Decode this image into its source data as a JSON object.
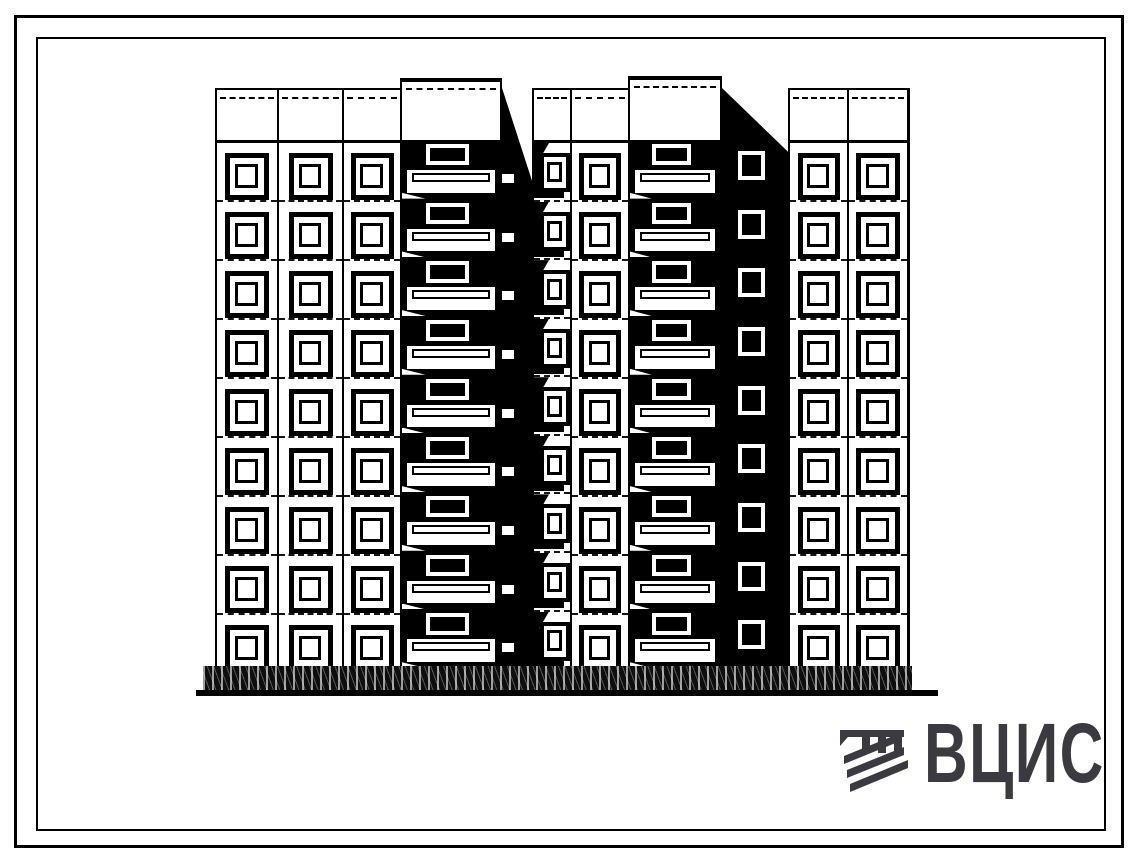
{
  "logo": {
    "text": "ВЦИС",
    "color": "#3a3a40",
    "icon": "vcis-stripes-icon"
  },
  "drawing": {
    "description": "front elevation of a 9-storey large-panel apartment block",
    "ink": "#000000",
    "paper": "#ffffff",
    "geometry": {
      "roof": 88,
      "parapet_bottom": 140,
      "base_top": 668,
      "floors": 9
    },
    "columns": [
      {
        "id": "col-a",
        "type": "windows",
        "x": 215,
        "w": 62,
        "win_w": 34,
        "win_h": 37
      },
      {
        "id": "col-b",
        "type": "windows",
        "x": 277,
        "w": 65,
        "win_w": 34,
        "win_h": 37
      },
      {
        "id": "col-c",
        "type": "windows",
        "x": 342,
        "w": 58,
        "win_w": 33,
        "win_h": 37
      },
      {
        "id": "shaft-1",
        "type": "shaft",
        "x": 400,
        "w": 102,
        "top": 78
      },
      {
        "id": "strip-1",
        "type": "strip",
        "x": 502,
        "w": 30,
        "diag": 0.16,
        "slabs": true
      },
      {
        "id": "col-d",
        "type": "windows",
        "x": 532,
        "w": 38,
        "win_w": 22,
        "win_h": 31,
        "narrow": true
      },
      {
        "id": "col-e",
        "type": "windows",
        "x": 570,
        "w": 58,
        "win_w": 32,
        "win_h": 37
      },
      {
        "id": "shaft-2",
        "type": "shaft",
        "x": 628,
        "w": 94,
        "top": 76
      },
      {
        "id": "strip-2",
        "type": "strip",
        "x": 722,
        "w": 66,
        "diag": 0.11,
        "windows": true,
        "strip_win": {
          "left": 16,
          "w": 27,
          "h": 29
        }
      },
      {
        "id": "col-f",
        "type": "windows",
        "x": 788,
        "w": 59,
        "win_w": 32,
        "win_h": 37
      },
      {
        "id": "col-g",
        "type": "windows",
        "x": 847,
        "w": 63,
        "win_w": 34,
        "win_h": 37,
        "edge": true
      }
    ]
  }
}
